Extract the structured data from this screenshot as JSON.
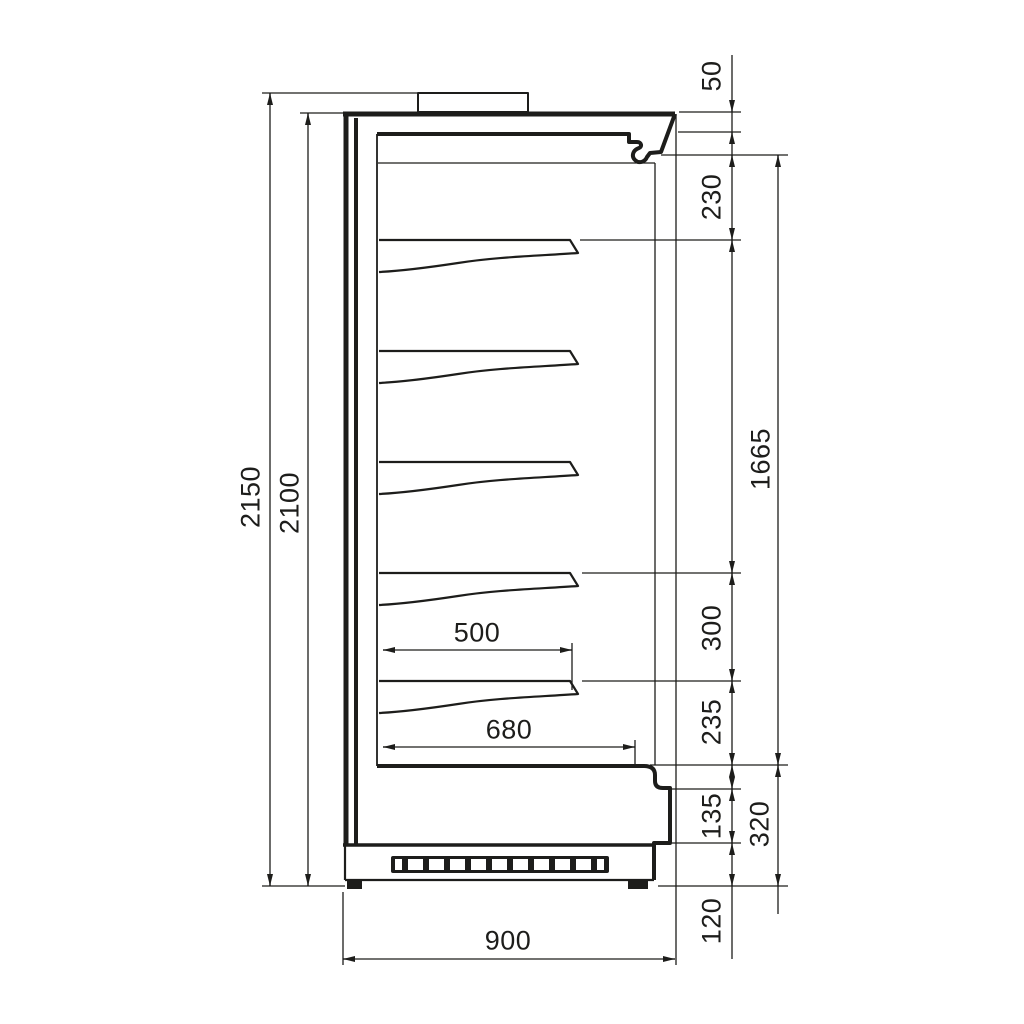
{
  "drawing": {
    "type": "refrigerated-multideck-cabinet-side-section",
    "units_shown": false
  },
  "dimensions": {
    "overall_height": "2150",
    "body_height": "2100",
    "canopy_front_height": "50",
    "canopy_to_first_shelf": "230",
    "display_opening_height": "1665",
    "shelf_spacing": "300",
    "bottom_shelf_to_deck": "235",
    "kick_panel_height": "135",
    "base_grille_height": "120",
    "lower_section_height": "320",
    "shelf_depth_upper": "500",
    "bottom_deck_depth": "680",
    "overall_depth": "900"
  }
}
